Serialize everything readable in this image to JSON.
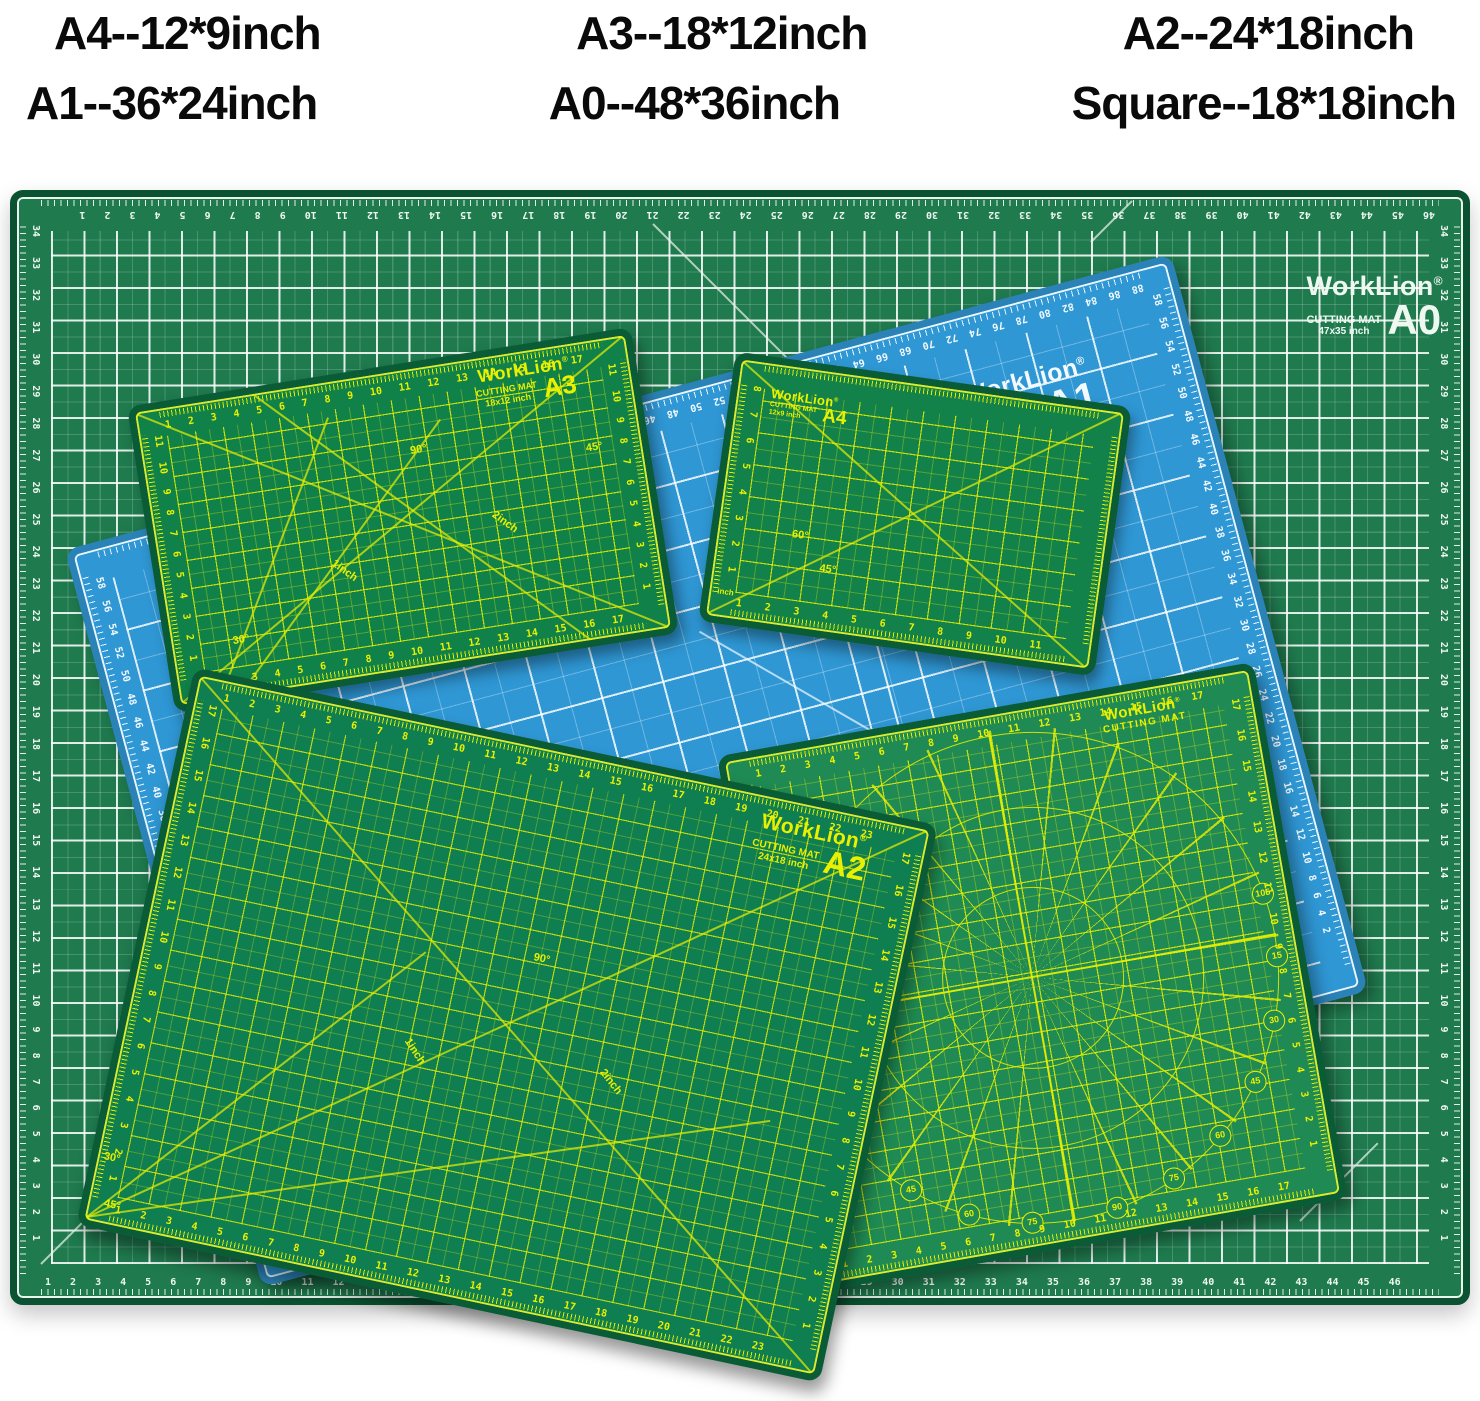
{
  "title_rows": {
    "row1": [
      "A4--12*9inch",
      "A3--18*12inch",
      "A2--24*18inch"
    ],
    "row2": [
      "A1--36*24inch",
      "A0--48*36inch",
      "Square--18*18inch"
    ]
  },
  "brand": "WorkLion",
  "registered_mark": "®",
  "product_line": "CUTTING MAT",
  "colors": {
    "page_background": "#ffffff",
    "header_text": "#0a0a0a",
    "mat_green_large": "#1f7a4e",
    "mat_green_small": "#11814a",
    "mat_blue": "#2f97d4",
    "grid_white": "#ffffff",
    "grid_yellow": "#e9f100",
    "mat_edge_green": "#0a5c36",
    "mat_edge_blue": "#2b82b6"
  },
  "mats": {
    "a0": {
      "code": "A0",
      "size_text": "47x35 inch",
      "ruler_top_desc": "46 45 44 43 42 41 40 39 38 37 36 35 34 33 32 31 30 29 28 27 26 25 24 23 22 21 20 19 18 17 16 15 14 13 12 11 10 9 8 7 6 5 4 3 2 1",
      "ruler_bottom": "1 2 3 4 5 6 7 8 9 10 11 12 13 14 15 16 17 18 19 20 21 22 23 24 25 26 27 28 29 30 31 32 33 34 35 36 37 38 39 40 41 42 43 44 45 46",
      "ruler_side": "34 33 32 31 30 29 28 27 26 25 24 23 22 21 20 19 18 17 16 15 14 13 12 11 10 9 8 7 6 5 4 3 2 1"
    },
    "a1": {
      "code": "A1",
      "size_text": "90x60 CM",
      "ruler_top_desc": "88 86 84 82 80 78 76 74 72 70 68 66 64 62 60 58 56 54 52 50 48 46 44 42 40 38 36 34 32 30 28 26 24 22 20 18 16 14 12 10 8 6 4 2",
      "ruler_side": "58 56 54 52 50 48 46 44 42 40 38 36 34 32 30 28 26 24 22 20 18 16 14 12 10 8 6 4 2"
    },
    "a2": {
      "code": "A2",
      "size_text": "24x18 inch",
      "ruler_h": "1 2 3 4 5 6 7 8 9 10 11 12 13 14 15 16 17 18 19 20 21 22 23",
      "ruler_side": "17 16 15 14 13 12 11 10 9 8 7 6 5 4 3 2 1",
      "angle_90": "90°",
      "angle_45": "45°",
      "angle_30": "30°",
      "inch_1": "1inch",
      "inch_2": "2inch"
    },
    "a3": {
      "code": "A3",
      "size_text": "18x12 inch",
      "ruler_h": "1 2 3 4 5 6 7 8 9 10 11 12 13 14 15 16 17",
      "ruler_side": "11 10 9 8 7 6 5 4 3 2 1",
      "angle_90": "90°",
      "angle_45": "45°",
      "angle_30": "30°",
      "inch_1": "1inch",
      "inch_2": "2inch"
    },
    "a4": {
      "code": "A4",
      "size_text": "12x9 inch",
      "ruler_bottom": "1 2 3 4 5 6 7 8 9 10 11",
      "ruler_side": "8 7 6 5 4 3 2 1",
      "angle_60": "60°",
      "angle_45": "45°",
      "unit": "inch"
    },
    "square": {
      "ruler_h": "1 2 3 4 5 6 7 8 9 10 11 12 13 14 15 16 17",
      "ruler_side": "17 16 15 14 13 12 11 10 9 8 7 6 5 4 3 2 1",
      "angle_labels": [
        "105",
        "15",
        "30",
        "45",
        "60",
        "75",
        "90",
        "75",
        "60",
        "45"
      ]
    }
  }
}
